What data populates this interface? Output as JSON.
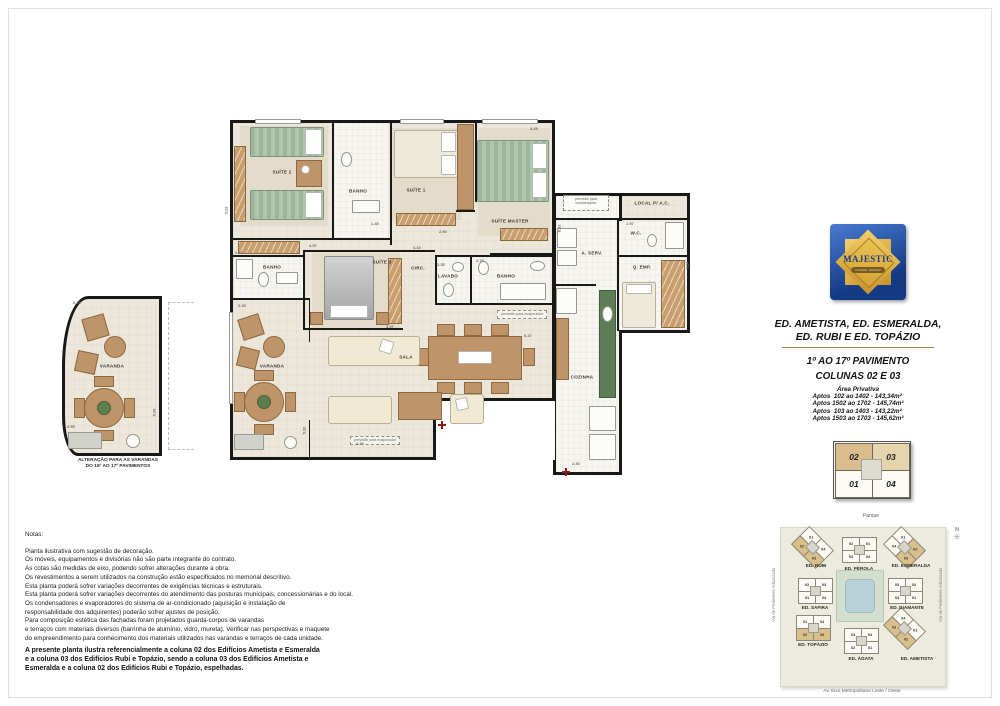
{
  "logo": {
    "name": "MAJESTIC",
    "tagline": "CIDADE JARDIM"
  },
  "title_block": {
    "line1": "ED. AMETISTA, ED. ESMERALDA,",
    "line2": "ED. RUBI E ED. TOPÁZIO",
    "floors": "1º AO 17º PAVIMENTO",
    "columns": "COLUNAS 02 E 03"
  },
  "area_block": {
    "title": "Área Privativa",
    "lines": [
      "Aptos  102 ao 1402 - 143,34m²",
      "Aptos 1502 ao 1702 - 145,74m²",
      "Aptos  103 ao 1403 - 143,22m²",
      "Aptos 1503 ao 1703 - 145,62m²"
    ]
  },
  "unit_key": {
    "units": [
      {
        "label": "02",
        "hl": true
      },
      {
        "label": "03",
        "hl": true
      },
      {
        "label": "01",
        "hl": false
      },
      {
        "label": "04",
        "hl": false
      }
    ],
    "caption": "Parque"
  },
  "floor_plan": {
    "rooms": [
      "SUÍTE 2",
      "BANHO",
      "SUÍTE 1",
      "SUÍTE MASTER",
      "LOCAL P/ A.C.",
      "W.C.",
      "A. SERV.",
      "Q. EMP.",
      "BANHO",
      "SUÍTE 3",
      "CIRC.",
      "LAVABO",
      "BANHO",
      "VARANDA",
      "SALA",
      "COZINHA"
    ],
    "annotations": {
      "condenser": "previsão para\ncondensador",
      "evaporator": "previsão para evaporador"
    },
    "dims": [
      "3.12",
      "1.45",
      "2.90",
      "3.25",
      "4.57",
      "2.27",
      "2.25",
      "4.10",
      "2.75",
      "1.35",
      "3.37",
      "6.47",
      "5.10",
      "4.40",
      "2.30",
      "1.97",
      "3.14",
      "8.51",
      "2.15"
    ]
  },
  "alt_varanda": {
    "room": "VARANDA",
    "caption_line1": "ALTERAÇÃO PARA AS VARANDAS",
    "caption_line2": "DO 15º AO 17º PAVIMENTOS",
    "dims": [
      "2.25",
      "2.95",
      "5.10"
    ]
  },
  "notes": {
    "title": "Notas:",
    "lines": [
      "Planta ilustrativa com sugestão de decoração.",
      "Os móveis, equipamentos e divisórias não são parte integrante do contrato.",
      "As cotas são medidas de eixo, podendo sofrer alterações durante a obra.",
      "Os revestimentos a serem utilizados na construção estão especificados no memorial descritivo.",
      "Esta planta poderá sofrer variações decorrentes de exigências técnicas e estruturais.",
      "Esta planta poderá sofrer variações decorrentes do atendimento das posturas municipais, concessionárias e do local.",
      "Os condensadores e evaporadores do sistema de ar-condicionado (aquisição e instalação de",
      "responsabilidade dos adquirentes) poderão sofrer ajustes de posição.",
      "Para composição estética das fachadas foram projetados guarda-corpos de varandas",
      "e terraços com materiais diversos (barrinha de alumínio, vidro, mureta). Verificar nas perspectivas e maquete",
      "do empreendimento para conhecimento dos materiais utilizados nas varandas e terraços de cada unidade."
    ]
  },
  "legal": {
    "lines": [
      "A presente planta ilustra referencialmente a coluna 02 dos Edifícios Ametista e Esmeralda",
      "e a coluna 03 dos Edifícios Rubi e Topázio, sendo a coluna 03 dos Edifícios Ametista e",
      "Esmeralda e a coluna 02 dos Edifícios Rubi e Topázio, espelhadas."
    ]
  },
  "site_plan": {
    "buildings": [
      {
        "name": "ED. RUBI",
        "shape": "diamond",
        "units": [
          {
            "n": "01",
            "hl": false
          },
          {
            "n": "04",
            "hl": false
          },
          {
            "n": "02",
            "hl": true
          },
          {
            "n": "03",
            "hl": true
          }
        ]
      },
      {
        "name": "ED. PÉROLA",
        "shape": "straight",
        "units": [
          {
            "n": "02",
            "hl": false
          },
          {
            "n": "01",
            "hl": false
          },
          {
            "n": "03",
            "hl": false
          },
          {
            "n": "04",
            "hl": false
          }
        ]
      },
      {
        "name": "ED. ESMERALDA",
        "shape": "diamond",
        "units": [
          {
            "n": "01",
            "hl": false
          },
          {
            "n": "02",
            "hl": true
          },
          {
            "n": "04",
            "hl": false
          },
          {
            "n": "03",
            "hl": true
          }
        ]
      },
      {
        "name": "ED. SAFIRA",
        "shape": "straight",
        "units": [
          {
            "n": "02",
            "hl": false
          },
          {
            "n": "03",
            "hl": false
          },
          {
            "n": "01",
            "hl": false
          },
          {
            "n": "04",
            "hl": false
          }
        ]
      },
      {
        "name": "ED. DIAMANTE",
        "shape": "straight",
        "units": [
          {
            "n": "03",
            "hl": false
          },
          {
            "n": "02",
            "hl": false
          },
          {
            "n": "04",
            "hl": false
          },
          {
            "n": "01",
            "hl": false
          }
        ]
      },
      {
        "name": "ED. TOPÁZIO",
        "shape": "straight",
        "units": [
          {
            "n": "01",
            "hl": false
          },
          {
            "n": "04",
            "hl": false
          },
          {
            "n": "02",
            "hl": true
          },
          {
            "n": "03",
            "hl": true
          }
        ]
      },
      {
        "name": "ED. ÁGATA",
        "shape": "straight",
        "units": [
          {
            "n": "03",
            "hl": false
          },
          {
            "n": "04",
            "hl": false
          },
          {
            "n": "02",
            "hl": false
          },
          {
            "n": "01",
            "hl": false
          }
        ]
      },
      {
        "name": "ED. AMETISTA",
        "shape": "diamond",
        "units": [
          {
            "n": "04",
            "hl": false
          },
          {
            "n": "01",
            "hl": false
          },
          {
            "n": "03",
            "hl": true
          },
          {
            "n": "02",
            "hl": true
          }
        ]
      }
    ],
    "left_street": "Via de Pedestres Arborizada",
    "right_street": "Via de Pedestres Arborizada",
    "bottom_street": "Av. Eixo Metropolitano Leste / Oeste",
    "compass_label": "N",
    "compass_icon": "✳"
  },
  "colors": {
    "wall": "#181818",
    "floor": "#ece7da",
    "wood": "#bf9468",
    "logo_blue": "#16377e",
    "logo_gold": "#e0ac33",
    "highlight_tan": "#d9bd8c",
    "accent_line": "#9c8a56"
  }
}
